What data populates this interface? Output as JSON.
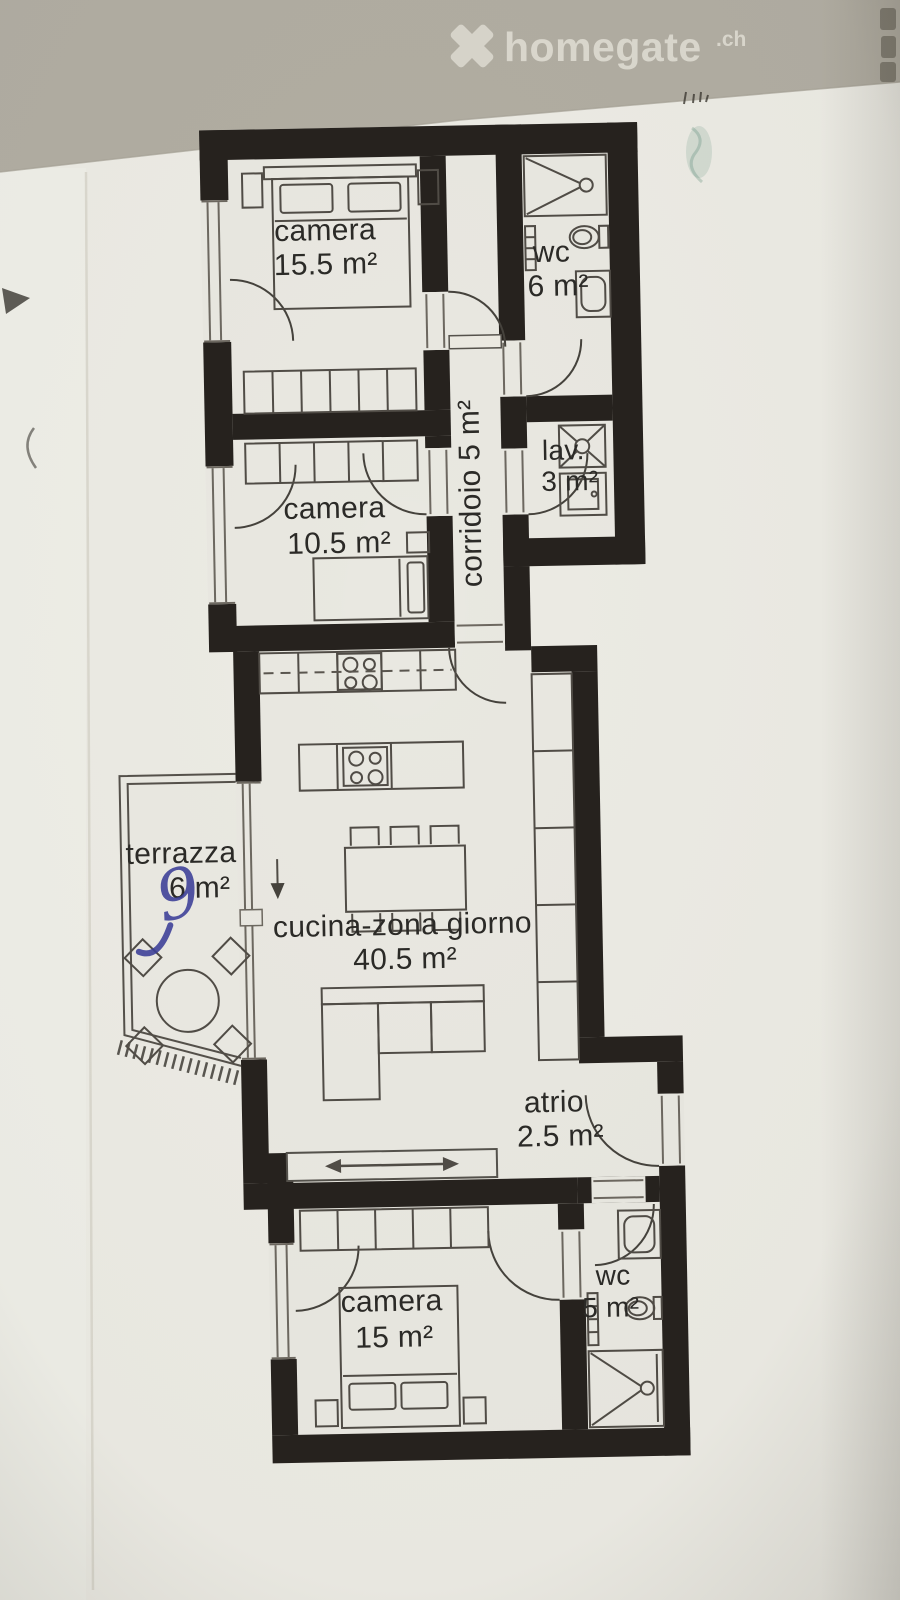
{
  "photo": {
    "watermark": {
      "brand": "homegate",
      "tld": ".ch",
      "logo": "x-cross"
    }
  },
  "rooms": {
    "camera_top": {
      "label": "camera",
      "area": "15.5 m²"
    },
    "wc_top": {
      "label": "wc",
      "area": "6 m²"
    },
    "corridoio": {
      "label": "corridoio 5 m²"
    },
    "lav": {
      "label": "lav.",
      "area": "3 m²"
    },
    "camera_middle": {
      "label": "camera",
      "area": "10.5 m²"
    },
    "terrazza": {
      "label": "terrazza",
      "area": "6 m²",
      "handwritten_note": "9"
    },
    "cucina": {
      "label": "cucina-zona giorno",
      "area": "40.5 m²"
    },
    "atrio": {
      "label": "atrio",
      "area": "2.5 m²"
    },
    "camera_bottom": {
      "label": "camera",
      "area": "15 m²"
    },
    "wc_bottom": {
      "label": "wc",
      "area": "5 m²"
    }
  },
  "furniture_symbols": [
    "double-bed",
    "single-bed",
    "wardrobe",
    "door-swing",
    "window-swing",
    "shower",
    "toilet",
    "washbasin",
    "radiator",
    "washing-machine",
    "laundry-appliance",
    "kitchen-counter",
    "hob",
    "kitchen-island",
    "dining-table",
    "dining-chair",
    "sofa",
    "shelf-unit",
    "sliding-door",
    "terrace-table",
    "terrace-chair",
    "entry-arrow",
    "terrace-railing"
  ],
  "colors": {
    "wall": "#26221e",
    "paper": "#ecebe4",
    "photo_band": "#b1ada2",
    "floor": "#e9e8e1",
    "watermark": "#dbd8ce",
    "handwriting_blue": "#3b3f99"
  }
}
